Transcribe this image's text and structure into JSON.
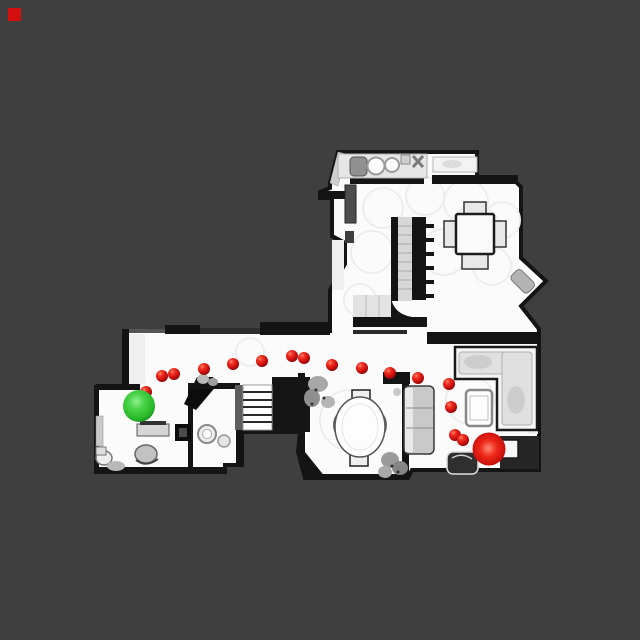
{
  "view": {
    "width": 640,
    "height": 640,
    "background_color": "#3f3f40"
  },
  "indicator": {
    "color": "#d40f0f",
    "x": 8,
    "y": 8,
    "size": 13
  },
  "floorplan": {
    "floor_color": "#fbfbfb",
    "wall_color": "#141414",
    "furniture_color": "#d9d9d9",
    "stair_count_lower": 6
  },
  "markers": {
    "start": {
      "label": "start-sphere-green",
      "color": "#2eb82e",
      "cx": 139,
      "cy": 406,
      "r": 16
    },
    "goal": {
      "label": "goal-sphere-red",
      "color": "#cc0d0d",
      "cx": 489,
      "cy": 449,
      "r": 16.5
    },
    "waypoints": {
      "color": "#cf1010",
      "radius": 6,
      "points": [
        [
          146,
          392
        ],
        [
          162,
          376
        ],
        [
          174,
          374
        ],
        [
          204,
          369
        ],
        [
          233,
          364
        ],
        [
          262,
          361
        ],
        [
          292,
          356
        ],
        [
          304,
          358
        ],
        [
          332,
          365
        ],
        [
          362,
          368
        ],
        [
          390,
          373
        ],
        [
          418,
          378
        ],
        [
          449,
          384
        ],
        [
          451,
          407
        ],
        [
          455,
          435
        ],
        [
          463,
          440
        ]
      ]
    }
  }
}
